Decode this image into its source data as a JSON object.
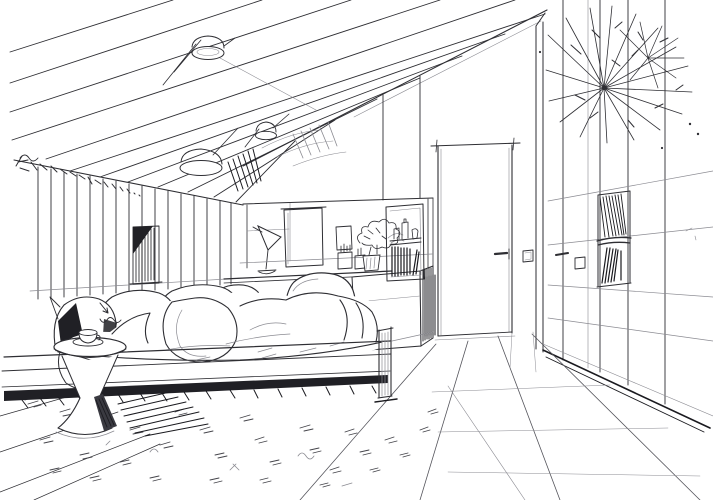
{
  "meta": {
    "title": "Attic bedroom interior — pen and ink perspective sketch",
    "description": "Hand-drawn black-and-white perspective sketch of an attic bedroom: sloped ceiling with rafter lines and drum spotlights, a curtained left wall with an illegible handwritten signature, a bed with pillows and a rumpled duvet, an hourglass pedestal side table with a cup, a built-in desk nook with lamp, pin board, plant, pen cups and an open shelf with books, a chair, an interior door with handle and light switches, a tall wardrobe wall with a recessed book niche and a starburst decoration, a shaggy area rug and a tiled floor."
  },
  "palette": {
    "paper": "#ffffff",
    "ink": "#2e2e33",
    "ink_dark": "#1a1a1f",
    "ink_light": "#8b8b92",
    "shadow": "#202025"
  },
  "signature": {
    "present": true,
    "legible": false,
    "location": "top-left wall edge"
  },
  "scene": {
    "objects": [
      "sloped-ceiling-rafters",
      "ceiling-drum-spotlights",
      "curtain-panel-left-wall",
      "artist-signature-scribble",
      "slatted-wall-window",
      "desk-nook-back-wall",
      "pin-board",
      "small-wall-frame",
      "desk-lamp",
      "desk-with-cabinet",
      "pen-cups",
      "potted-plant",
      "open-shelf-with-books",
      "office-chair",
      "interior-door",
      "door-handle",
      "light-switches",
      "wardrobe-wall",
      "recessed-book-niche",
      "starburst-decoration",
      "bed-with-pillows",
      "rumpled-duvet",
      "bed-post",
      "pedestal-side-table",
      "coffee-cup",
      "area-rug",
      "tiled-floor",
      "baseboard-shadow"
    ]
  }
}
